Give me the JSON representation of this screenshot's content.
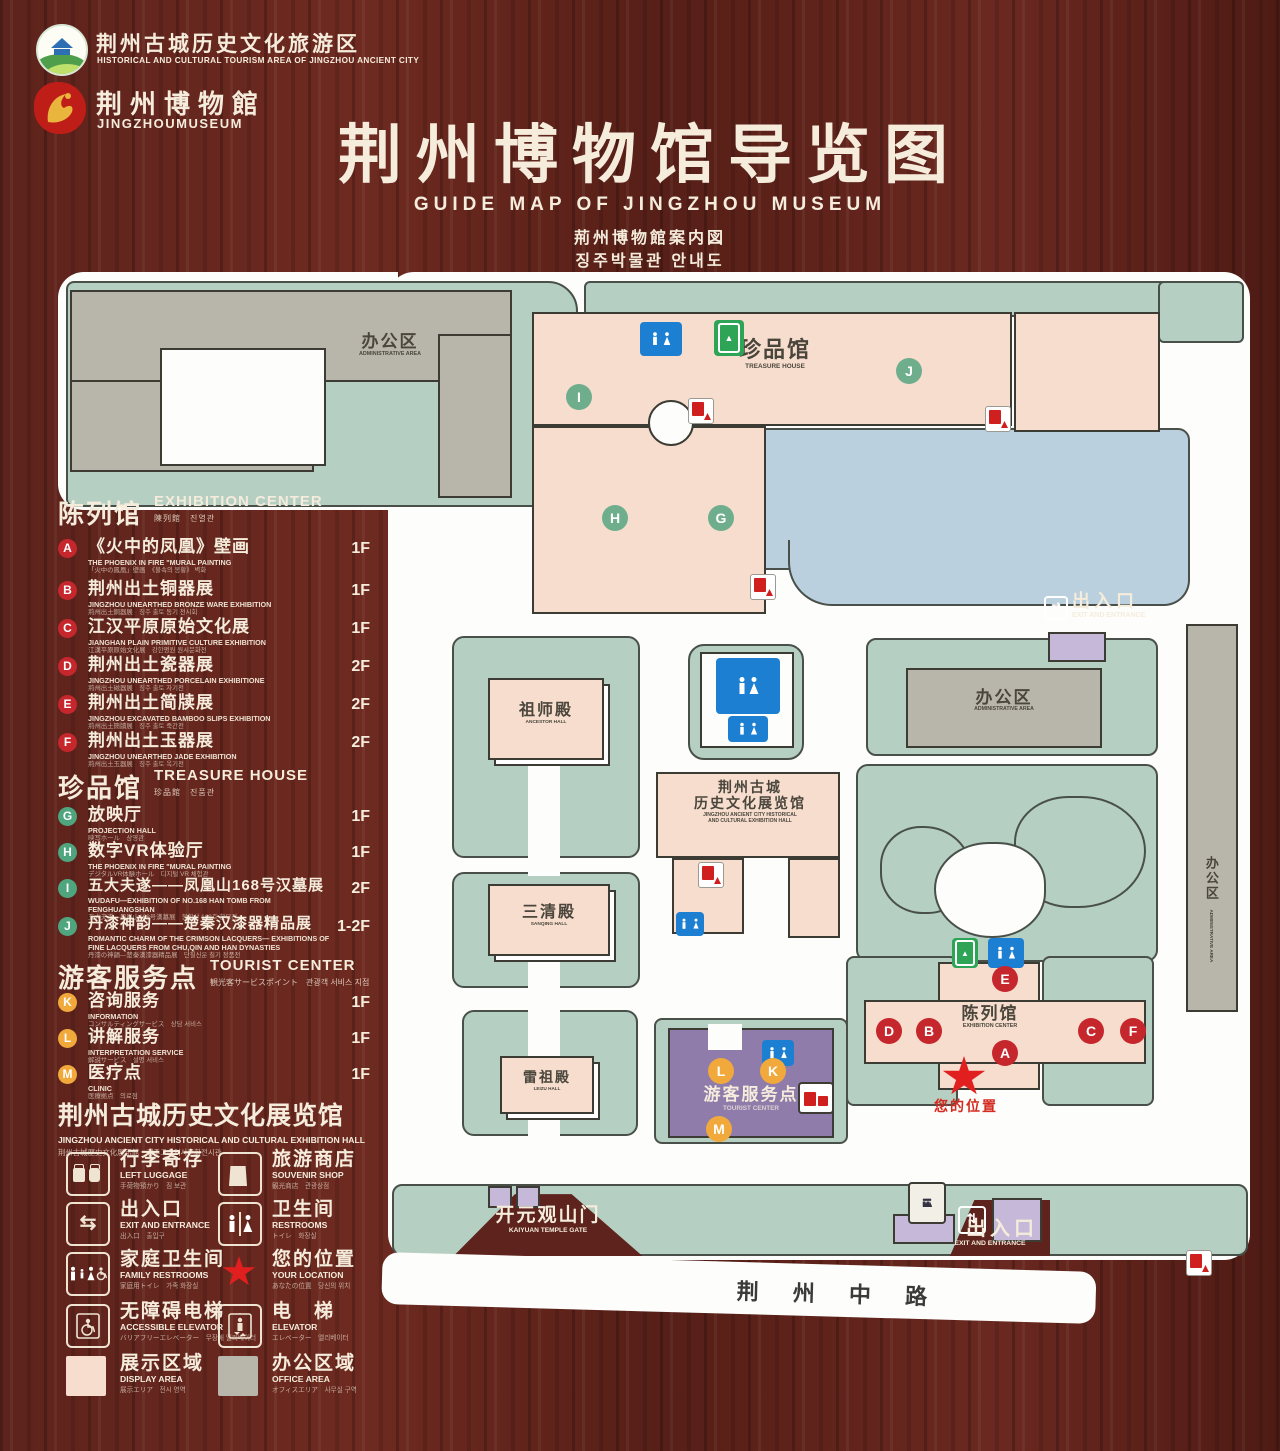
{
  "brand": {
    "tourism_logo": {
      "zh": "荆州古城历史文化旅游区",
      "en": "HISTORICAL AND CULTURAL TOURISM AREA OF JINGZHOU ANCIENT CITY"
    },
    "museum_logo": {
      "zh": "荆州博物館",
      "en": "JINGZHOUMUSEUM"
    }
  },
  "title": {
    "zh": "荆州博物馆导览图",
    "en": "GUIDE MAP OF JINGZHOU MUSEUM",
    "ja": "荊州博物館案内図",
    "ko": "징주박물관 안내도"
  },
  "legend": {
    "exhibition": {
      "title_zh": "陈列馆",
      "title_en": "EXHIBITION CENTER",
      "title_sub": "陳列館　진열관",
      "items": [
        {
          "letter": "A",
          "zh": "《火中的凤凰》壁画",
          "en": "THE PHOENIX IN FIRE \"MURAL PAINTING",
          "sub": "「火中の鳳凰」壁画　《불속의 봉황》 벽화",
          "floor": "1F"
        },
        {
          "letter": "B",
          "zh": "荆州出土铜器展",
          "en": "JINGZHOU UNEARTHED BRONZE WARE EXHIBITION",
          "sub": "荊州出土銅器展　징주 출토 동기 전시회",
          "floor": "1F"
        },
        {
          "letter": "C",
          "zh": "江汉平原原始文化展",
          "en": "JIANGHAN PLAIN PRIMITIVE CULTURE EXHIBITION",
          "sub": "江漢平原原始文化展　강한평원 원시문화전",
          "floor": "1F"
        },
        {
          "letter": "D",
          "zh": "荆州出土瓷器展",
          "en": "JINGZHOU UNEARTHED PORCELAIN EXHIBITIONE",
          "sub": "荊州出土磁器展　징주 출토 자기전",
          "floor": "2F"
        },
        {
          "letter": "E",
          "zh": "荆州出土简牍展",
          "en": "JINGZHOU EXCAVATED BAMBOO SLIPS EXHIBITION",
          "sub": "荊州出土簡牘展　징주 출토 죽간전",
          "floor": "2F"
        },
        {
          "letter": "F",
          "zh": "荆州出土玉器展",
          "en": "JINGZHOU UNEARTHED JADE EXHIBITION",
          "sub": "荊州出土玉器展　징주 출토 옥기전",
          "floor": "2F"
        }
      ]
    },
    "treasure": {
      "title_zh": "珍品馆",
      "title_en": "TREASURE HOUSE",
      "title_sub": "珍品館　진품관",
      "items": [
        {
          "letter": "G",
          "zh": "放映厅",
          "en": "PROJECTION HALL",
          "sub": "映写ホール　상영관",
          "floor": "1F"
        },
        {
          "letter": "H",
          "zh": "数字VR体验厅",
          "en": "THE PHOENIX IN FIRE \"MURAL PAINTING",
          "sub": "デジタルVR体験ホール　디지털 VR 체험관",
          "floor": "1F"
        },
        {
          "letter": "I",
          "zh": "五大夫遂——凤凰山168号汉墓展",
          "en": "WUDAFU—EXHIBITION OF NO.168 HAN TOMB FROM FENGHUANGSHAN",
          "sub": "五大夫遂—鳳凰山168号漢墓展　봉황산 168호 한묘전",
          "floor": "2F"
        },
        {
          "letter": "J",
          "zh": "丹漆神韵——楚秦汉漆器精品展",
          "en": "ROMANTIC CHARM OF THE CRIMSON LACQUERS— EXHIBITIONS OF FINE LACQUERS FROM CHU,QIN AND HAN DYNASTIES",
          "sub": "丹漆の神韻—楚秦漢漆器精品展　단칠신운 칠기 정품전",
          "floor": "1-2F"
        }
      ]
    },
    "tourist": {
      "title_zh": "游客服务点",
      "title_en": "TOURIST CENTER",
      "title_sub": "観光客サービスポイント　관광객 서비스 지점",
      "items": [
        {
          "letter": "K",
          "zh": "咨询服务",
          "en": "INFORMATION",
          "sub": "コンサルティングサービス　상담 서비스",
          "floor": "1F"
        },
        {
          "letter": "L",
          "zh": "讲解服务",
          "en": "INTERPRETATION SERVICE",
          "sub": "解説サービス　설명 서비스",
          "floor": "1F"
        },
        {
          "letter": "M",
          "zh": "医疗点",
          "en": "CLINIC",
          "sub": "医療拠点　의료점",
          "floor": "1F"
        }
      ]
    },
    "hall_note": {
      "zh": "荆州古城历史文化展览馆",
      "en": "JINGZHOU ANCIENT CITY HISTORICAL AND CULTURAL EXHIBITION HALL",
      "sub": "荆州古城歴史文化展示館　징주고성역사문화전시관"
    }
  },
  "icon_legend": [
    {
      "icon": "left-luggage-icon",
      "zh": "行李寄存",
      "en": "LEFT LUGGAGE",
      "sub": "手荷物預かり　짐 보관"
    },
    {
      "icon": "souvenir-shop-icon",
      "zh": "旅游商店",
      "en": "SOUVENIR SHOP",
      "sub": "観光商店　관광상점"
    },
    {
      "icon": "exit-entrance-icon",
      "zh": "出入口",
      "en": "EXIT AND ENTRANCE",
      "sub": "出入口　출입구"
    },
    {
      "icon": "restrooms-icon",
      "zh": "卫生间",
      "en": "RESTROOMS",
      "sub": "トイレ　화장실"
    },
    {
      "icon": "family-restrooms-icon",
      "zh": "家庭卫生间",
      "en": "FAMILY RESTROOMS",
      "sub": "家庭用トイレ　가족 화장실"
    },
    {
      "icon": "your-location-icon",
      "zh": "您的位置",
      "en": "YOUR LOCATION",
      "sub": "あなたの位置　당신의 위치"
    },
    {
      "icon": "accessible-elevator-icon",
      "zh": "无障碍电梯",
      "en": "ACCESSIBLE ELEVATOR",
      "sub": "バリアフリーエレベーター　무장애 엘리베이터"
    },
    {
      "icon": "elevator-icon",
      "zh": "电　梯",
      "en": "ELEVATOR",
      "sub": "エレベーター　엘리베이터"
    },
    {
      "icon": "display-area-swatch",
      "zh": "展示区域",
      "en": "DISPLAY AREA",
      "sub": "展示エリア　전시 영역"
    },
    {
      "icon": "office-area-swatch",
      "zh": "办公区域",
      "en": "OFFICE AREA",
      "sub": "オフィスエリア　사무실 구역"
    }
  ],
  "map": {
    "labels": {
      "admin_top": {
        "zh": "办公区",
        "en": "ADMINISTRATIVE AREA"
      },
      "admin_right": {
        "zh": "办公区",
        "en": "ADMINISTRATIVE AREA"
      },
      "admin_side": {
        "zh": "办公区",
        "en": "ADMINISTRATIVE AREA"
      },
      "treasure_house": {
        "zh": "珍品馆",
        "en": "TREASURE HOUSE"
      },
      "ancestor_hall": {
        "zh": "祖师殿",
        "en": "ANCESTOR HALL"
      },
      "sanqing_hall": {
        "zh": "三清殿",
        "en": "SANQING HALL"
      },
      "leizu_hall": {
        "zh": "雷祖殿",
        "en": "LEIZU HALL"
      },
      "exhibition_hall": {
        "zh1": "荆州古城",
        "zh2": "历史文化展览馆",
        "en1": "JINGZHOU ANCIENT CITY HISTORICAL",
        "en2": "AND CULTURAL EXHIBITION HALL"
      },
      "exhibition_center": {
        "zh": "陈列馆",
        "en": "EXHIBITION CENTER"
      },
      "tourist_center": {
        "zh": "游客服务点",
        "en": "TOURIST CENTER"
      },
      "kaiyuan_gate": {
        "zh": "开元观山门",
        "en": "KAIYUAN TEMPLE GATE"
      },
      "exit_right": {
        "zh": "出入口",
        "en": "EXIT AND ENTRANCE"
      },
      "exit_bottom": {
        "zh": "出入口",
        "en": "EXIT AND ENTRANCE"
      },
      "road": {
        "zh": "荆 州 中 路"
      },
      "your_location": {
        "zh": "您的位置"
      }
    },
    "markers": {
      "treasure": [
        "I",
        "J",
        "H",
        "G"
      ],
      "exhibition": [
        "E",
        "D",
        "B",
        "C",
        "F",
        "A"
      ],
      "tourist": [
        "L",
        "K",
        "M"
      ]
    }
  },
  "colors": {
    "wood": "#5d231c",
    "sage": "#b5cfc2",
    "building_pink": "#f7ddce",
    "building_gray": "#b8b5aa",
    "water": "#bad0de",
    "restroom_blue": "#1d7fd1",
    "elevator_green": "#2ea457",
    "tourist_purple": "#8f7cab",
    "gate_lavender": "#c6b8d8",
    "badge_red": "#c5272d",
    "badge_green": "#6fae8d",
    "badge_orange": "#f2a93b",
    "star_red": "#e21f1f"
  }
}
